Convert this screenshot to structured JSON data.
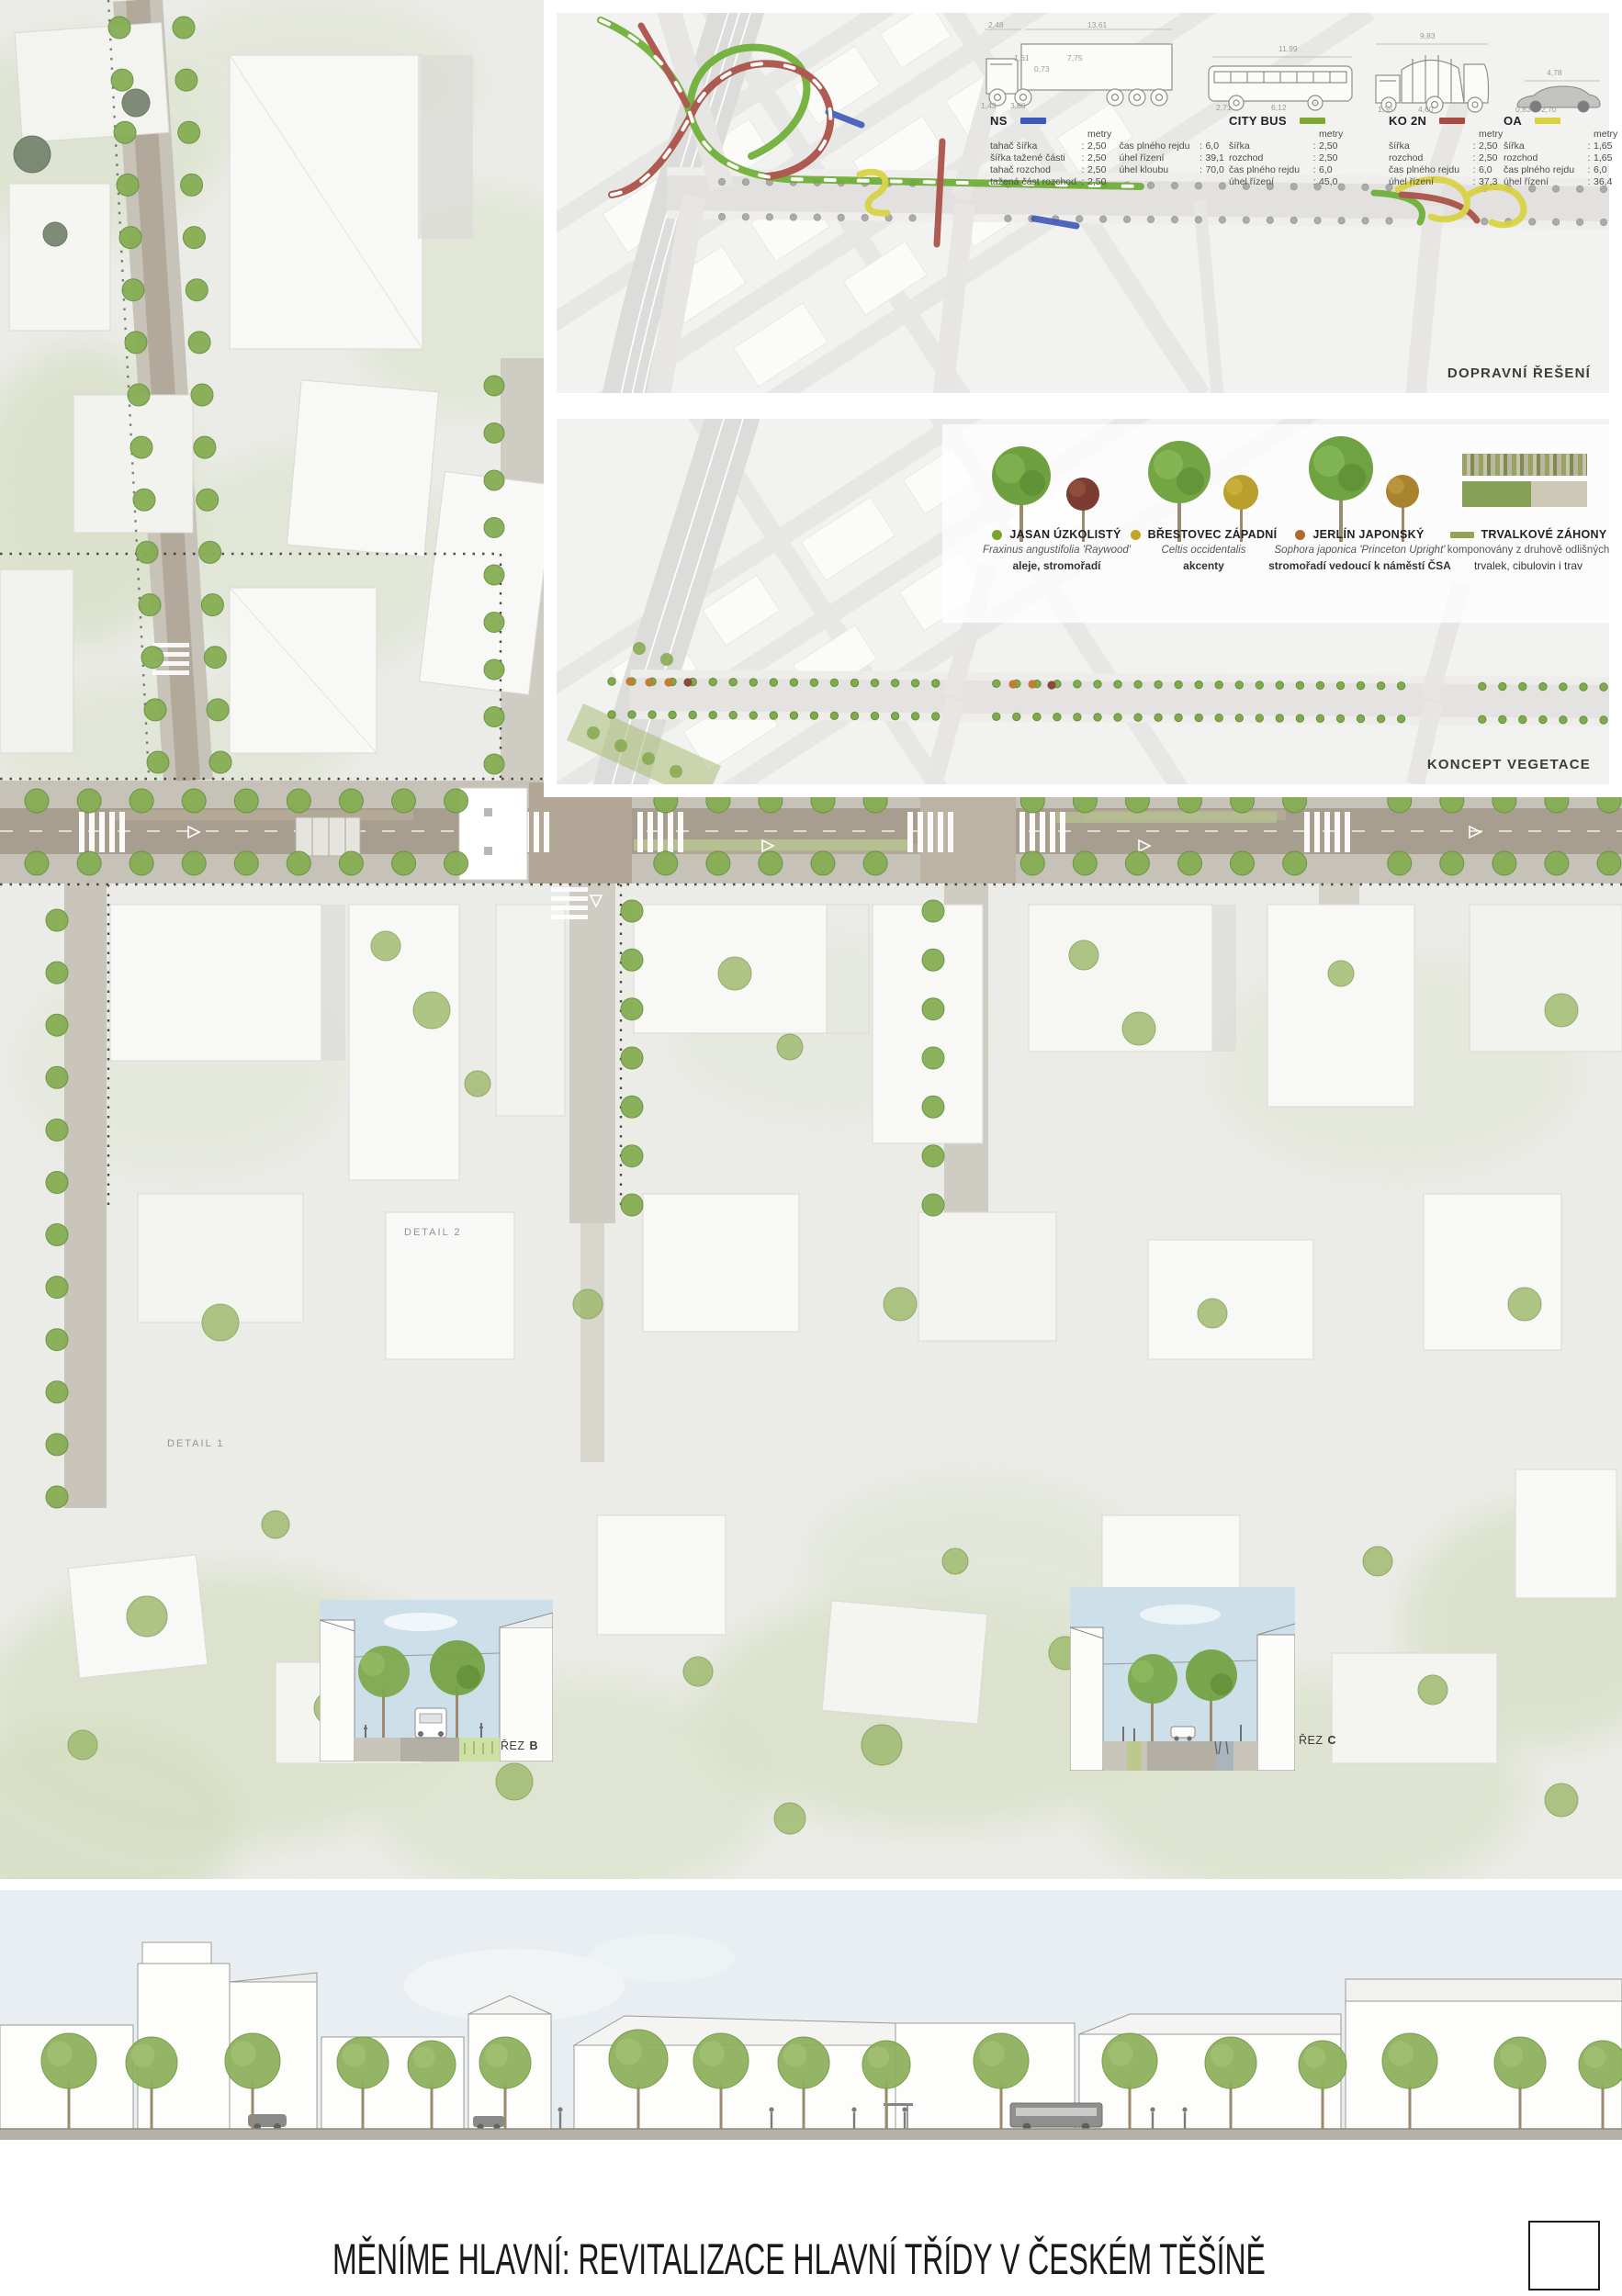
{
  "poster": {
    "title": "MĚNÍME HLAVNÍ: REVITALIZACE HLAVNÍ TŘÍDY V ČESKÉM TĚŠÍNĚ"
  },
  "colors": {
    "ns_blue": "#3d58b8",
    "bus_green": "#7ea830",
    "ko_red": "#a84b40",
    "oa_yellow": "#d9d23c",
    "route_green": "#6aae32",
    "jasan_green": "#7ba32c",
    "brestovec_gold": "#c3a328",
    "jerlin_brown": "#b06a2e",
    "trvalky_olive": "#97a254",
    "tree_green": "#85ad53"
  },
  "traffic_panel": {
    "caption": "DOPRAVNÍ ŘEŠENÍ",
    "sep": ":",
    "vehicles": [
      {
        "id": "ns",
        "label": "NS",
        "color": "ns_blue",
        "unit": "metry",
        "icon": "semi-trailer-truck-diagram",
        "dims": [
          "2,48",
          "13,61",
          "1,61",
          "7,75",
          "0,73",
          "1,43",
          "3,80"
        ],
        "rows": [
          [
            "tahač šířka",
            "2,50"
          ],
          [
            "šířka tažené části",
            "2,50"
          ],
          [
            "tahač rozchod",
            "2,50"
          ],
          [
            "tažená část rozchod",
            "2,50"
          ]
        ],
        "rows2": [
          [
            "čas plného rejdu",
            "6,0"
          ],
          [
            "úhel řízení",
            "39,1"
          ],
          [
            "úhel kloubu",
            "70,0"
          ]
        ]
      },
      {
        "id": "citybus",
        "label": "CITY BUS",
        "color": "bus_green",
        "unit": "metry",
        "icon": "city-bus-diagram",
        "dims": [
          "11,99",
          "2,71",
          "6,12"
        ],
        "rows": [
          [
            "šířka",
            "2,50"
          ],
          [
            "rozchod",
            "2,50"
          ],
          [
            "čas plného rejdu",
            "6,0"
          ],
          [
            "úhel řízení",
            "45,0"
          ]
        ]
      },
      {
        "id": "ko2n",
        "label": "KO 2N",
        "color": "ko_red",
        "unit": "metry",
        "icon": "garbage-truck-diagram",
        "dims": [
          "9,83",
          "1,35",
          "4,60"
        ],
        "rows": [
          [
            "šířka",
            "2,50"
          ],
          [
            "rozchod",
            "2,50"
          ],
          [
            "čas plného rejdu",
            "6,0"
          ],
          [
            "úhel řízení",
            "37,3"
          ]
        ]
      },
      {
        "id": "oa",
        "label": "OA",
        "color": "oa_yellow",
        "unit": "metry",
        "icon": "passenger-car-diagram",
        "dims": [
          "4,78",
          "0,83",
          "2,70"
        ],
        "rows": [
          [
            "šířka",
            "1,65"
          ],
          [
            "rozchod",
            "1,65"
          ],
          [
            "čas plného rejdu",
            "6,0"
          ],
          [
            "úhel řízení",
            "36,4"
          ]
        ]
      }
    ]
  },
  "vegetation_panel": {
    "caption": "KONCEPT VEGETACE",
    "items": [
      {
        "name": "JASAN ÚZKOLISTÝ",
        "species": "Fraxinus angustifolia 'Raywood'",
        "role": "aleje, stromořadí",
        "dot": "jasan_green",
        "dot_shape": "dot",
        "italic": true,
        "bold_role": true,
        "icon": "green-tree-with-red-accent-tree"
      },
      {
        "name": "BŘESTOVEC ZÁPADNÍ",
        "species": "Celtis occidentalis",
        "role": "akcenty",
        "dot": "brestovec_gold",
        "dot_shape": "dot",
        "italic": true,
        "bold_role": true,
        "icon": "green-tree-with-yellow-accent-tree"
      },
      {
        "name": "JERLÍN JAPONSKÝ",
        "species": "Sophora japonica 'Princeton Upright'",
        "role": "stromořadí vedoucí k náměstí ČSA",
        "dot": "jerlin_brown",
        "dot_shape": "dot",
        "italic": true,
        "bold_role": true,
        "icon": "green-tree-with-gold-accent-tree"
      },
      {
        "name": "TRVALKOVÉ ZÁHONY",
        "species": "komponovány z druhově odlišných",
        "role": "trvalek, cibulovin i trav",
        "dot": "trvalky_olive",
        "dot_shape": "bar",
        "italic": false,
        "bold_role": false,
        "icon": "perennial-bed-swatch"
      }
    ]
  },
  "plan": {
    "detail_1": "DETAIL 1",
    "detail_2": "DETAIL 2",
    "section_b": {
      "prefix": "ŘEZ",
      "letter": "B"
    },
    "section_c": {
      "prefix": "ŘEZ",
      "letter": "C"
    }
  }
}
